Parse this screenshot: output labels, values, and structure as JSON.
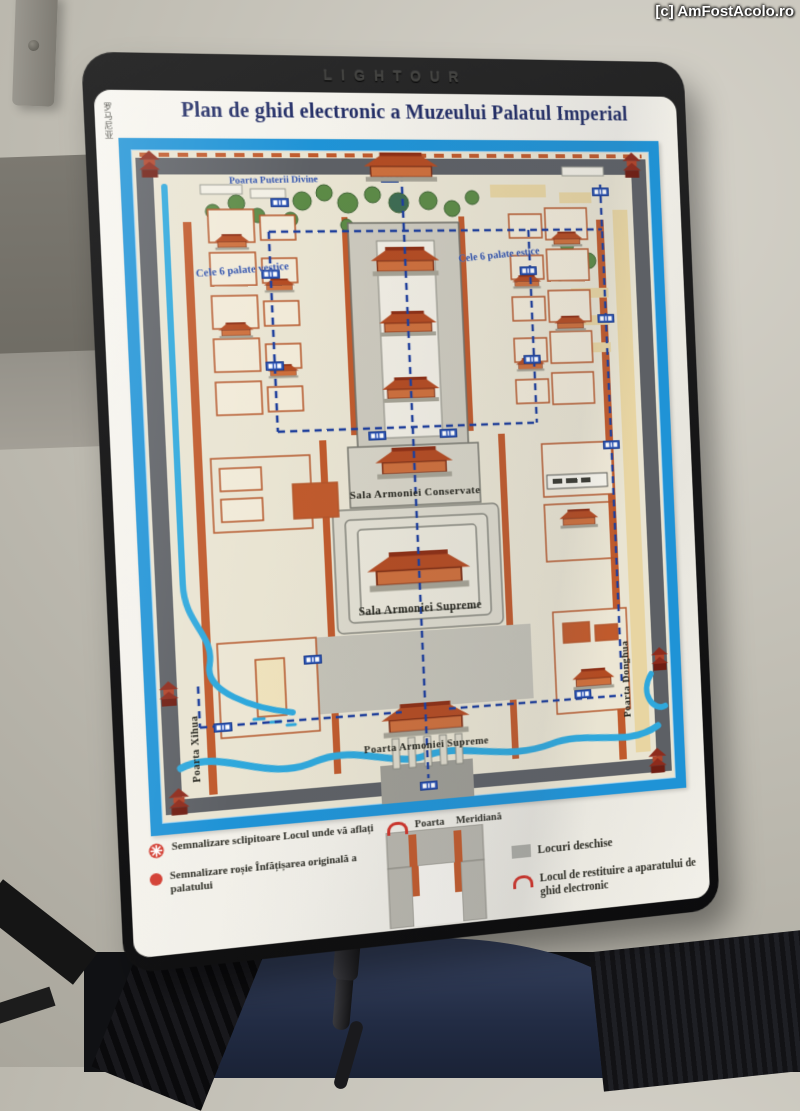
{
  "watermark": "[c] AmFostAcolo.ro",
  "device": {
    "brand": "LIGHTOUR",
    "side_label_cn": "罗马尼亚"
  },
  "title": "Plan de ghid electronic a Muzeului Palatul Imperial",
  "map": {
    "labels": {
      "north_gate": "Poarta Puterii Divine",
      "west_palaces": "Cele 6 palate vestice",
      "east_palaces": "Cele 6 palate estice",
      "hall_preserved": "Sala Armoniei Conservate",
      "hall_supreme": "Sala Armoniei Supreme",
      "gate_supreme": "Poarta Armoniei Supreme",
      "west_gate": "Poarta Xihua",
      "east_gate": "Poarta Donghua",
      "meridian_gate": "Poarta Meridiană"
    }
  },
  "legend": {
    "items": [
      {
        "icon": "starburst-icon",
        "text": "Semnalizare sclipitoare Locul unde vă aflați"
      },
      {
        "icon": "red-dot-icon",
        "text": "Semnalizare roșie Înfățișarea originală a palatului"
      },
      {
        "icon": "open-area-swatch",
        "text": "Locuri deschise"
      },
      {
        "icon": "headphones-icon",
        "text": "Locul de restituire a aparatului de ghid electronic"
      }
    ]
  },
  "colors": {
    "frame_blue": "#1f93d6",
    "map_beige": "#e9e4d2",
    "building_orange": "#c05a2c",
    "river_cyan": "#2fa8dc",
    "route_navy": "#1d3e9c",
    "title_navy": "#222d66",
    "legend_red": "#d23a2e",
    "open_gray": "#ababa4",
    "wall_gray": "#5d6065"
  }
}
